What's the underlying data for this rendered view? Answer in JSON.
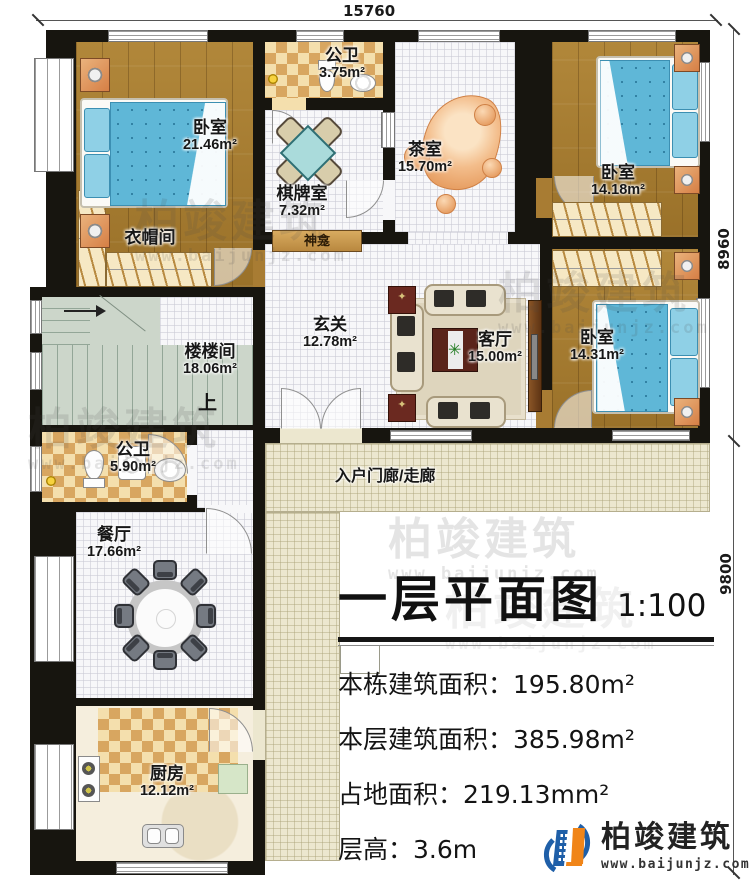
{
  "dims": {
    "top": "15760",
    "right_upper": "8960",
    "right_lower": "9800"
  },
  "rooms": {
    "bedroom1": {
      "name": "卧室",
      "area": "21.46m²"
    },
    "cloakroom": {
      "name": "衣帽间"
    },
    "bath_top": {
      "name": "公卫",
      "area": "3.75m²"
    },
    "games": {
      "name": "棋牌室",
      "area": "7.32m²"
    },
    "shrine": {
      "name": "神龛"
    },
    "tea": {
      "name": "茶室",
      "area": "15.70m²"
    },
    "bedroom2": {
      "name": "卧室",
      "area": "14.18m²"
    },
    "bedroom3": {
      "name": "卧室",
      "area": "14.31m²"
    },
    "hall": {
      "name": "玄关",
      "area": "12.78m²"
    },
    "living": {
      "name": "客厅",
      "area": "15.00m²"
    },
    "stairs": {
      "name": "楼楼间",
      "area": "18.06m²",
      "up": "上"
    },
    "bath_mid": {
      "name": "公卫",
      "area": "5.90m²"
    },
    "dining": {
      "name": "餐厅",
      "area": "17.66m²"
    },
    "kitchen": {
      "name": "厨房",
      "area": "12.12m²"
    },
    "porch": {
      "name": "入户门廊/走廊"
    }
  },
  "title_block": {
    "title": "一层平面图",
    "scale": "1:100",
    "stats": [
      {
        "label": "本栋建筑面积：",
        "value": "195.80m²"
      },
      {
        "label": "本层建筑面积：",
        "value": "385.98m²"
      },
      {
        "label": "占地面积：",
        "value": "219.13mm²"
      },
      {
        "label": "层高：",
        "value": "3.6m"
      }
    ]
  },
  "branding": {
    "name": "柏竣建筑",
    "url": "www.baijunjz.com"
  },
  "watermark": {
    "name": "柏竣建筑",
    "url": "www.baijunjz.com"
  },
  "icons": {
    "plant": "✳",
    "star": "✦"
  },
  "colors": {
    "wall": "#17150f",
    "wood": "#a87c33",
    "bed": "#5fb7d7",
    "brand_blue": "#1f5fa8",
    "brand_orange": "#f08519"
  }
}
